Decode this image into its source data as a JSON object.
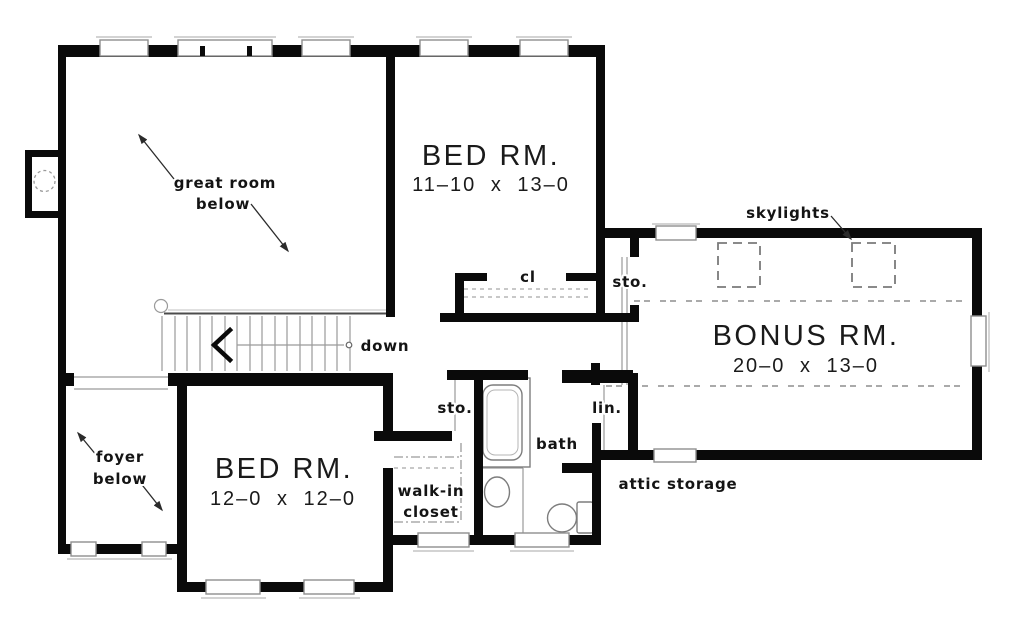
{
  "rooms": {
    "great_room": {
      "line1": "great room",
      "line2": "below"
    },
    "foyer": {
      "line1": "foyer",
      "line2": "below"
    },
    "bedroom_upper": {
      "name": "BED RM.",
      "dims": "11–10 x 13–0"
    },
    "bedroom_lower": {
      "name": "BED RM.",
      "dims": "12–0 x 12–0"
    },
    "bonus_room": {
      "name": "BONUS RM.",
      "dims": "20–0 x 13–0"
    },
    "closet": {
      "label": "cl"
    },
    "storage_hall": {
      "label": "sto."
    },
    "storage_bath": {
      "label": "sto."
    },
    "linen": {
      "label": "lin."
    },
    "bath": {
      "label": "bath"
    },
    "walk_in_closet": {
      "line1": "walk-in",
      "line2": "closet"
    },
    "attic_storage": {
      "label": "attic storage"
    }
  },
  "annotations": {
    "skylights": "skylights",
    "stairs_down": "down"
  },
  "colors": {
    "wall": "#0a0a0a",
    "background": "#ffffff",
    "thin_line": "#9a9a9a"
  }
}
